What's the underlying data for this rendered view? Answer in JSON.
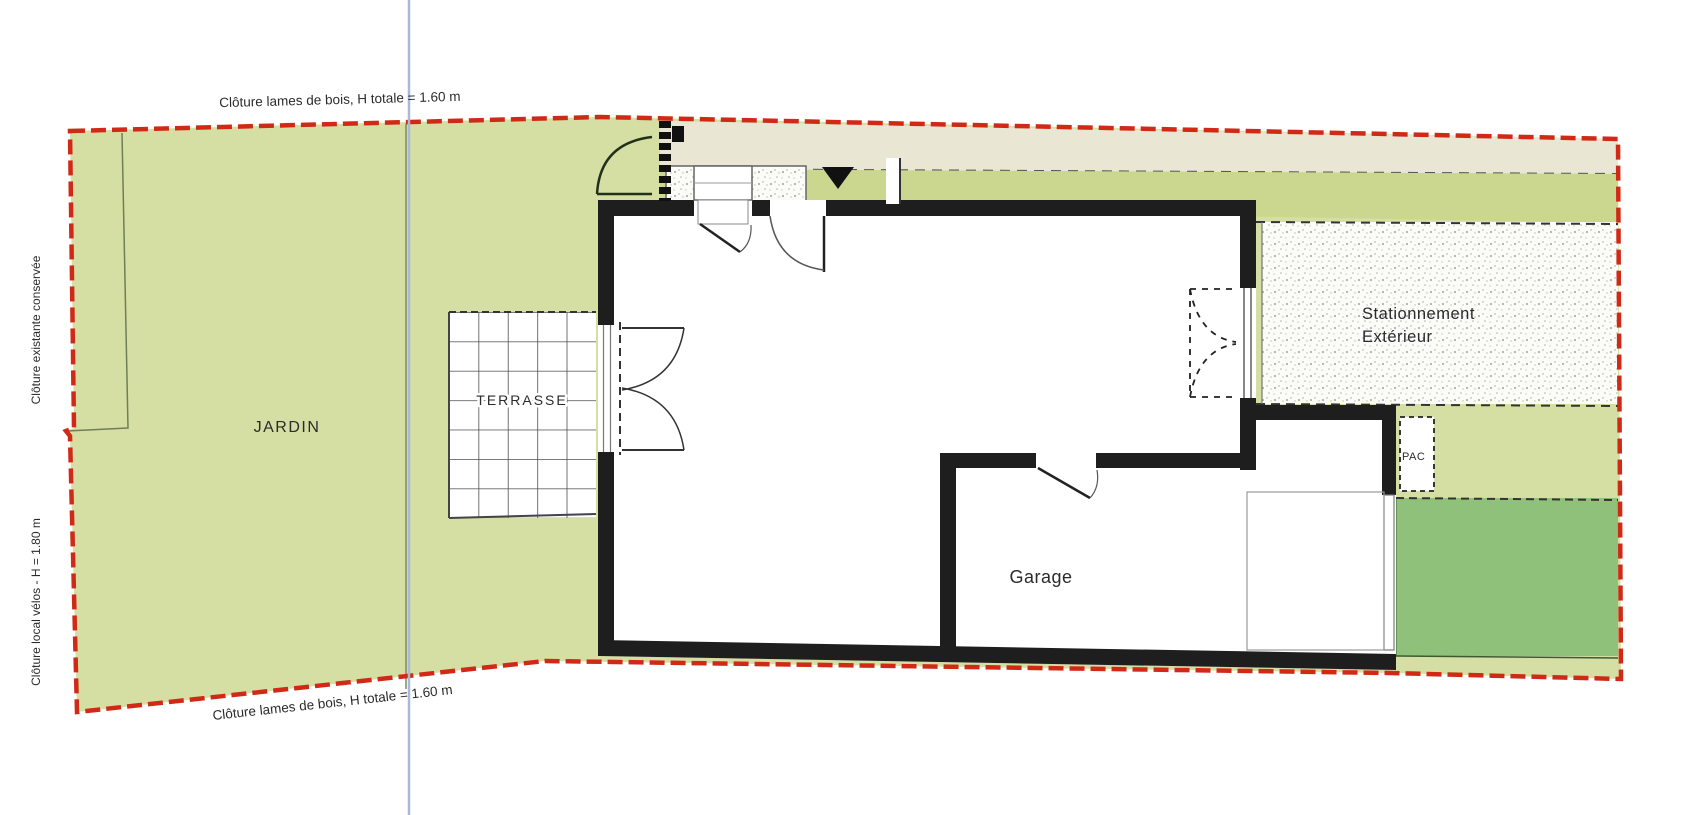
{
  "plan": {
    "labels": {
      "fence_top": "Clôture lames de bois, H totale = 1.60 m",
      "fence_bottom": "Clôture lames de bois, H totale = 1.60 m",
      "fence_left_existing": "Clôture existante conservée",
      "fence_left_bike": "Clôture local vélos - H = 1.80 m",
      "garden": "JARDIN",
      "terrace": "TERRASSE",
      "garage": "Garage",
      "parking_line1": "Stationnement",
      "parking_line2": "Extérieur",
      "heat_pump": "PAC"
    },
    "colors": {
      "boundary_red": "#d02a17",
      "garden_green": "#d6dfa3",
      "band_green": "#cbd78f",
      "path_khaki": "#e9e7d3",
      "lawn_dark_green": "#8fc17b",
      "axis_blue": "#a8bad8",
      "wall_black": "#1e1e1e"
    }
  }
}
